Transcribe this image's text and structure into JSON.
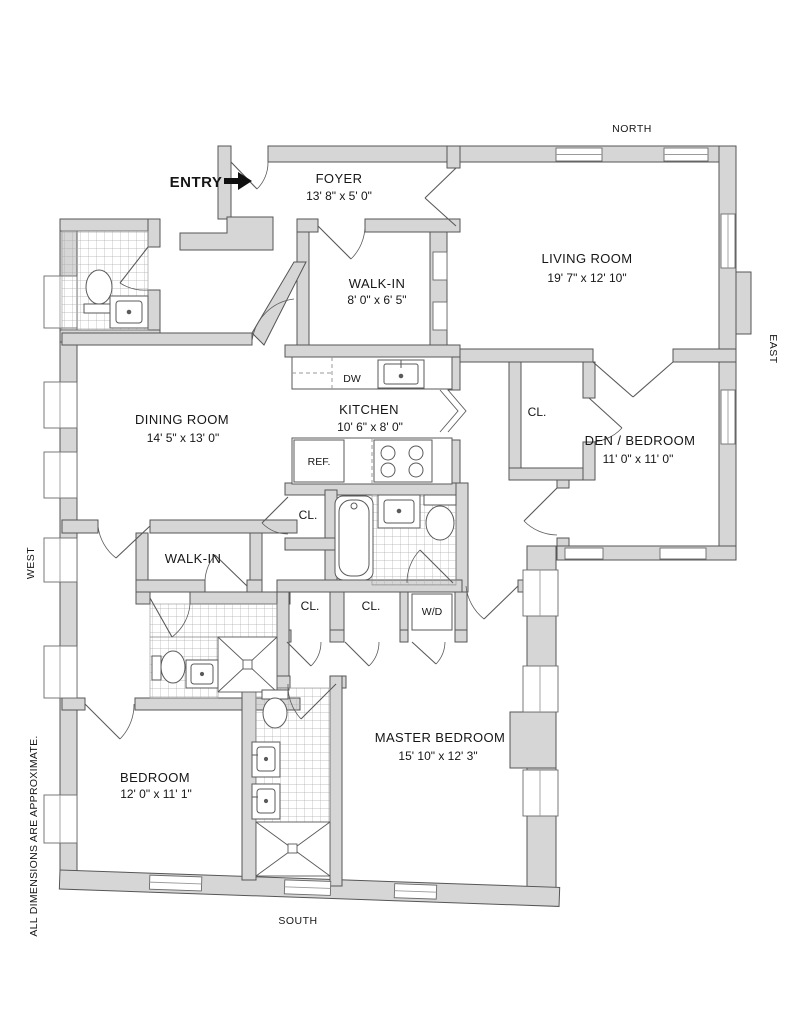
{
  "plan_type": "apartment-floor-plan",
  "rooms": {
    "foyer": {
      "name": "FOYER",
      "dims": "13' 8\" x 5' 0\""
    },
    "living": {
      "name": "LIVING ROOM",
      "dims": "19' 7\" x 12' 10\""
    },
    "walkin_upper": {
      "name": "WALK-IN",
      "dims": "8' 0\" x 6' 5\""
    },
    "dining": {
      "name": "DINING ROOM",
      "dims": "14' 5\" x 13' 0\""
    },
    "kitchen": {
      "name": "KITCHEN",
      "dims": "10' 6\" x 8' 0\""
    },
    "den": {
      "name": "DEN / BEDROOM",
      "dims": "11' 0\" x 11' 0\""
    },
    "walkin_lower": {
      "name": "WALK-IN"
    },
    "master": {
      "name": "MASTER BEDROOM",
      "dims": "15' 10\" x 12' 3\""
    },
    "bedroom": {
      "name": "BEDROOM",
      "dims": "12' 0\" x 11' 1\""
    }
  },
  "labels": {
    "closet": "CL.",
    "washer_dryer": "W/D",
    "dishwasher": "DW",
    "refrigerator": "REF.",
    "entry": "ENTRY"
  },
  "compass": {
    "north": "NORTH",
    "south": "SOUTH",
    "east": "EAST",
    "west": "WEST"
  },
  "disclaimer": "ALL DIMENSIONS ARE APPROXIMATE.",
  "colors": {
    "wall": "#d6d6d6",
    "line": "#565656",
    "tile": "#a9a9a9",
    "text": "#161616"
  }
}
